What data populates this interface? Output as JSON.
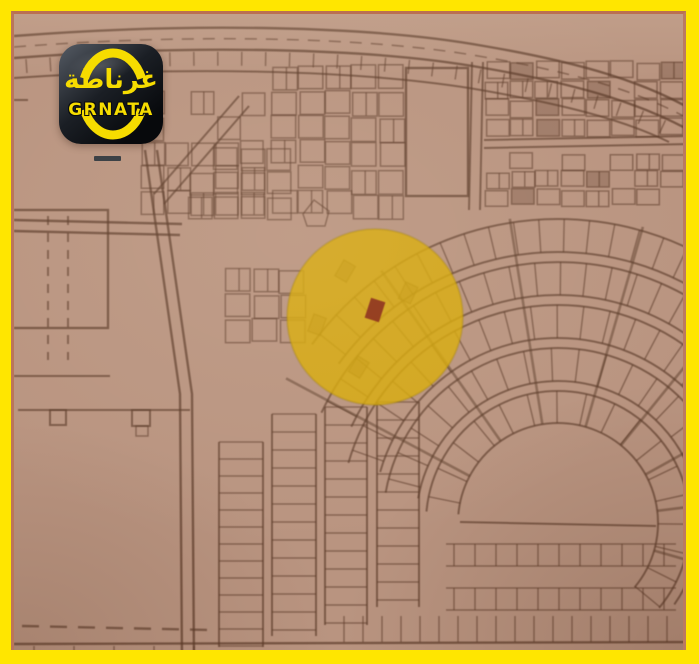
{
  "logo": {
    "arabic_name": "غرناطة",
    "brand_name": "GRNATA"
  },
  "colors": {
    "frame_yellow": "#ffe600",
    "map_background": "#b99480",
    "map_lines": "#5c3b28",
    "highlight_yellow": "#d9a900",
    "marker_red": "#8e2c12",
    "logo_yellow": "#f6dc00",
    "logo_black": "#101318",
    "photo_edge_line": "#bb4d26"
  },
  "map": {
    "type": "photographed-cadastral-plot-map",
    "highlight": {
      "shape": "circle",
      "cx": 361,
      "cy": 303,
      "r": 88,
      "opacity": 0.82
    },
    "marker": {
      "shape": "plot-rectangle",
      "cx": 361,
      "cy": 296,
      "width": 15,
      "height": 21,
      "rotation_deg": 18
    }
  }
}
